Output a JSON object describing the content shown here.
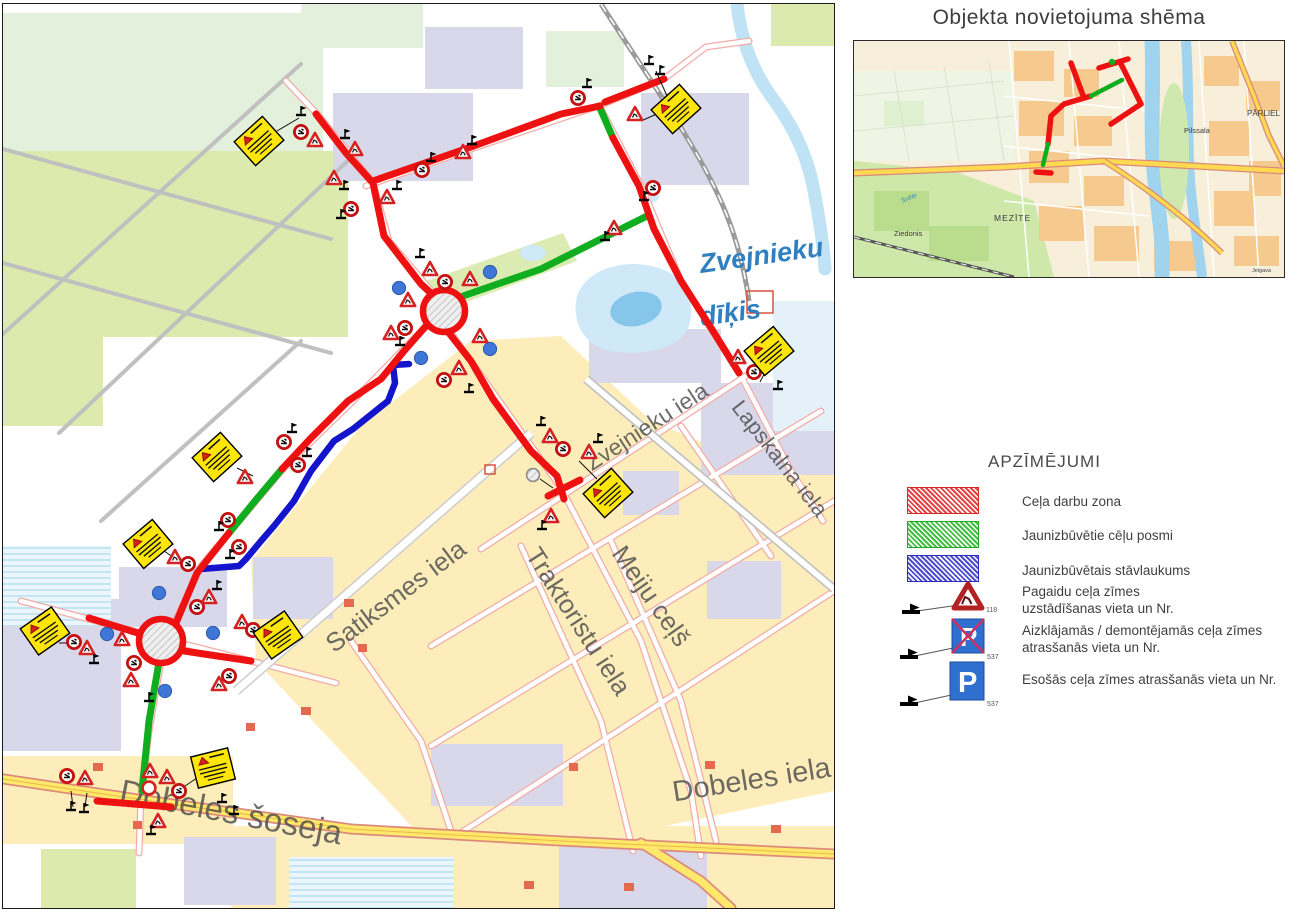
{
  "doc": {
    "inset_title": "Objekta novietojuma shēma"
  },
  "main_map": {
    "streets": {
      "zvejnieku": "Zvejnieku iela",
      "lapskalna": "Lapskalna iela",
      "satiksmes": "Satiksmes iela",
      "traktoristu": "Traktoristu iela",
      "meiju": "Meiju ceļš",
      "dobeles_soseja": "Dobeles šoseja",
      "dobeles_iela": "Dobeles iela"
    },
    "water": {
      "pond_line1": "Zvejnieku",
      "pond_line2": "dīķis"
    }
  },
  "inset": {
    "labels": {
      "parliel": "PĀRLIEL",
      "pilssala": "Pilssala",
      "mezite": "MEZĪTE",
      "ziedonis": "Ziedonis",
      "svete": "Svēte",
      "jelgava": "Jelgava"
    }
  },
  "legend": {
    "title": "APZĪMĒJUMI",
    "items": [
      {
        "label": "Ceļa darbu zona",
        "color": "#e03030"
      },
      {
        "label": "Jaunizbūvētie cēļu posmi",
        "color": "#2eb82e"
      },
      {
        "label": "Jaunizbūvētais stāvlaukums",
        "color": "#3333cc"
      }
    ],
    "signs": [
      {
        "number": "118",
        "line1": "Pagaidu ceļa zīmes",
        "line2": "uzstādīšanas vieta un Nr."
      },
      {
        "number": "537",
        "line1": "Aizklājamās / demontējamās ceļa zīmes",
        "line2": "atrasšanās vieta un Nr."
      },
      {
        "number": "537",
        "line1": "Esošās ceļa zīmes atrasšanās vieta un Nr.",
        "line2": ""
      }
    ]
  },
  "colors": {
    "route_red": "#ee1111",
    "route_green": "#10ad1e",
    "route_blue": "#1414cc",
    "plate_yellow": "#ffe60a",
    "highway_yellow": "#ffe86a",
    "water_blue": "#cfe9f8",
    "sign_blue": "#2f6fd0"
  }
}
